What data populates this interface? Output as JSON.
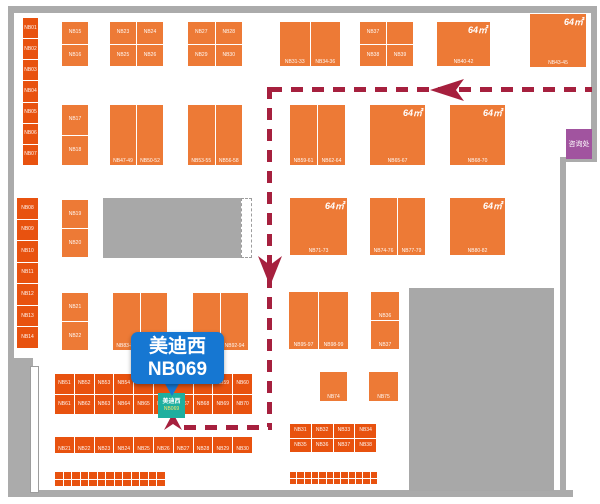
{
  "canvas": {
    "width": 600,
    "height": 504,
    "background": "#ffffff"
  },
  "colors": {
    "booth_orange": "#ED7A36",
    "booth_red": "#E8520F",
    "wall_gray": "#ABABAB",
    "block_gray": "#A8A8A8",
    "path_crimson": "#A6203E",
    "callout_blue": "#1677D2",
    "highlight_teal": "#1FAF9F",
    "info_purple": "#A1549F"
  },
  "callout": {
    "x": 131,
    "y": 332,
    "w": 93,
    "h": 52,
    "line1": "美迪西",
    "line2": "NB069",
    "tail": {
      "x": 164,
      "y": 382,
      "size": 14
    }
  },
  "highlight_booth": {
    "x": 158,
    "y": 393,
    "w": 27,
    "h": 25,
    "name": "美迪西",
    "booth_no": "NB069"
  },
  "info_box": {
    "x": 566,
    "y": 129,
    "w": 26,
    "h": 30,
    "label": "咨询处"
  },
  "structure": {
    "walls": [
      {
        "x": 8,
        "y": 6,
        "w": 589,
        "h": 7
      },
      {
        "x": 8,
        "y": 6,
        "w": 6,
        "h": 354
      },
      {
        "x": 591,
        "y": 6,
        "w": 6,
        "h": 155
      },
      {
        "x": 560,
        "y": 157,
        "w": 37,
        "h": 5
      },
      {
        "x": 560,
        "y": 157,
        "w": 6,
        "h": 340
      },
      {
        "x": 13,
        "y": 490,
        "w": 560,
        "h": 7
      },
      {
        "x": 8,
        "y": 358,
        "w": 25,
        "h": 139
      }
    ],
    "gray_blocks": [
      {
        "x": 103,
        "y": 198,
        "w": 139,
        "h": 60
      },
      {
        "x": 409,
        "y": 288,
        "w": 145,
        "h": 203
      }
    ],
    "white_slot": {
      "x": 30,
      "y": 366,
      "w": 9,
      "h": 127
    },
    "dashed_tab": {
      "x": 241,
      "y": 198,
      "w": 11,
      "h": 60
    }
  },
  "path": {
    "segments": [
      {
        "type": "h",
        "x": 270,
        "y": 87,
        "len": 322
      },
      {
        "type": "v",
        "x": 267,
        "y": 87,
        "len": 340
      },
      {
        "type": "h",
        "x": 184,
        "y": 425,
        "len": 88
      }
    ],
    "arrows": [
      {
        "dir": "left",
        "x": 430,
        "y": 79,
        "w": 34,
        "h": 22
      },
      {
        "dir": "down",
        "x": 258,
        "y": 256,
        "w": 24,
        "h": 30
      },
      {
        "dir": "up",
        "x": 164,
        "y": 413,
        "w": 18,
        "h": 17
      }
    ]
  },
  "booths": [
    {
      "id": "strip-left-1",
      "x": 23,
      "y": 18,
      "w": 15,
      "h": 147,
      "tone": "red",
      "cols": 1,
      "rows": 7,
      "labelPos": "center",
      "labels": [
        "NB01",
        "NB02",
        "NB03",
        "NB04",
        "NB05",
        "NB06",
        "NB07"
      ]
    },
    {
      "id": "strip-left-2",
      "x": 17,
      "y": 198,
      "w": 21,
      "h": 150,
      "tone": "red",
      "cols": 1,
      "rows": 7,
      "labelPos": "center",
      "labels": [
        "NB08",
        "NB09",
        "NB10",
        "NB11",
        "NB12",
        "NB13",
        "NB14"
      ]
    },
    {
      "id": "col-a",
      "x": 62,
      "y": 22,
      "w": 26,
      "h": 44,
      "tone": "orange",
      "cols": 1,
      "rows": 2,
      "labelPos": "center",
      "labels": [
        "NB15",
        "NB16"
      ]
    },
    {
      "id": "col-b",
      "x": 62,
      "y": 105,
      "w": 26,
      "h": 60,
      "tone": "orange",
      "cols": 1,
      "rows": 2,
      "labelPos": "center",
      "labels": [
        "NB17",
        "NB18"
      ]
    },
    {
      "id": "col-c",
      "x": 62,
      "y": 200,
      "w": 26,
      "h": 57,
      "tone": "orange",
      "cols": 1,
      "rows": 2,
      "labelPos": "center",
      "labels": [
        "NB19",
        "NB20"
      ]
    },
    {
      "id": "col-d",
      "x": 62,
      "y": 293,
      "w": 26,
      "h": 57,
      "tone": "orange",
      "cols": 1,
      "rows": 2,
      "labelPos": "center",
      "labels": [
        "NB21",
        "NB22"
      ]
    },
    {
      "id": "a1",
      "x": 110,
      "y": 22,
      "w": 53,
      "h": 44,
      "tone": "orange",
      "cols": 2,
      "rows": 2,
      "labelPos": "center",
      "labels": [
        "NB23",
        "NB24",
        "NB25",
        "NB26"
      ]
    },
    {
      "id": "a2",
      "x": 188,
      "y": 22,
      "w": 54,
      "h": 44,
      "tone": "orange",
      "cols": 2,
      "rows": 2,
      "labelPos": "center",
      "labels": [
        "NB27",
        "NB28",
        "NB29",
        "NB30"
      ]
    },
    {
      "id": "a3",
      "x": 280,
      "y": 22,
      "w": 60,
      "h": 44,
      "tone": "orange",
      "cols": 2,
      "rows": 1,
      "labelPos": "bottom",
      "labels": [
        "NB31-33",
        "NB34-36"
      ]
    },
    {
      "id": "a4",
      "x": 360,
      "y": 22,
      "w": 53,
      "h": 44,
      "tone": "orange",
      "cols": 2,
      "rows": 2,
      "labelPos": "center",
      "labels": [
        "NB37",
        "",
        "NB38",
        "NB39"
      ]
    },
    {
      "id": "a5",
      "x": 437,
      "y": 22,
      "w": 53,
      "h": 44,
      "tone": "orange",
      "cols": 1,
      "rows": 1,
      "labelPos": "bottom",
      "labels": [
        "NB40-42"
      ],
      "area": "64㎡"
    },
    {
      "id": "a6",
      "x": 530,
      "y": 14,
      "w": 56,
      "h": 53,
      "tone": "orange",
      "cols": 1,
      "rows": 1,
      "labelPos": "bottom",
      "labels": [
        "NB43-45"
      ],
      "area": "64㎡"
    },
    {
      "id": "b1",
      "x": 110,
      "y": 105,
      "w": 53,
      "h": 60,
      "tone": "orange",
      "cols": 2,
      "rows": 1,
      "labelPos": "bottom",
      "labels": [
        "NB47-49",
        "NB50-52"
      ]
    },
    {
      "id": "b2",
      "x": 188,
      "y": 105,
      "w": 54,
      "h": 60,
      "tone": "orange",
      "cols": 2,
      "rows": 1,
      "labelPos": "bottom",
      "labels": [
        "NB53-55",
        "NB56-58"
      ]
    },
    {
      "id": "b3",
      "x": 290,
      "y": 105,
      "w": 55,
      "h": 60,
      "tone": "orange",
      "cols": 2,
      "rows": 1,
      "labelPos": "bottom",
      "labels": [
        "NB59-61",
        "NB62-64"
      ]
    },
    {
      "id": "b4",
      "x": 370,
      "y": 105,
      "w": 55,
      "h": 60,
      "tone": "orange",
      "cols": 1,
      "rows": 1,
      "labelPos": "bottom",
      "labels": [
        "NB65-67"
      ],
      "area": "64㎡"
    },
    {
      "id": "b5",
      "x": 450,
      "y": 105,
      "w": 55,
      "h": 60,
      "tone": "orange",
      "cols": 1,
      "rows": 1,
      "labelPos": "bottom",
      "labels": [
        "NB68-70"
      ],
      "area": "64㎡"
    },
    {
      "id": "c1",
      "x": 290,
      "y": 198,
      "w": 57,
      "h": 57,
      "tone": "orange",
      "cols": 1,
      "rows": 1,
      "labelPos": "bottom",
      "labels": [
        "NB71-73"
      ],
      "area": "64㎡"
    },
    {
      "id": "c2",
      "x": 370,
      "y": 198,
      "w": 55,
      "h": 57,
      "tone": "orange",
      "cols": 2,
      "rows": 1,
      "labelPos": "bottom",
      "labels": [
        "NB74-76",
        "NB77-79"
      ]
    },
    {
      "id": "c3",
      "x": 450,
      "y": 198,
      "w": 55,
      "h": 57,
      "tone": "orange",
      "cols": 1,
      "rows": 1,
      "labelPos": "bottom",
      "labels": [
        "NB80-82"
      ],
      "area": "64㎡"
    },
    {
      "id": "d1",
      "x": 113,
      "y": 293,
      "w": 54,
      "h": 57,
      "tone": "orange",
      "cols": 2,
      "rows": 1,
      "labelPos": "bottom",
      "labels": [
        "NB83-85",
        "NB86-88"
      ]
    },
    {
      "id": "d2",
      "x": 193,
      "y": 293,
      "w": 55,
      "h": 57,
      "tone": "orange",
      "cols": 2,
      "rows": 1,
      "labelPos": "bottom",
      "labels": [
        "NB89-91",
        "NB92-94"
      ]
    },
    {
      "id": "d3",
      "x": 289,
      "y": 292,
      "w": 59,
      "h": 57,
      "tone": "orange",
      "cols": 2,
      "rows": 1,
      "labelPos": "bottom",
      "labels": [
        "NB95-97",
        "NB98-99"
      ]
    },
    {
      "id": "d4",
      "x": 371,
      "y": 292,
      "w": 28,
      "h": 57,
      "tone": "orange",
      "cols": 1,
      "rows": 2,
      "labelPos": "bottom",
      "labels": [
        "NB36",
        "NB37"
      ]
    },
    {
      "id": "sq1",
      "x": 320,
      "y": 372,
      "w": 27,
      "h": 29,
      "tone": "orange",
      "cols": 1,
      "rows": 1,
      "labelPos": "bottom",
      "labels": [
        "NB74"
      ]
    },
    {
      "id": "sq2",
      "x": 369,
      "y": 372,
      "w": 29,
      "h": 29,
      "tone": "orange",
      "cols": 1,
      "rows": 1,
      "labelPos": "bottom",
      "labels": [
        "NB75"
      ]
    },
    {
      "id": "row-e",
      "x": 55,
      "y": 374,
      "w": 197,
      "h": 40,
      "tone": "red",
      "cols": 10,
      "rows": 2,
      "labelPos": "center",
      "labels": [
        "NB51",
        "NB52",
        "NB53",
        "NB54",
        "NB55",
        "NB56",
        "NB57",
        "NB58",
        "NB59",
        "NB60",
        "NB61",
        "NB62",
        "NB63",
        "NB64",
        "NB65",
        "NB66",
        "NB67",
        "NB68",
        "NB69",
        "NB70"
      ]
    },
    {
      "id": "row-f",
      "x": 55,
      "y": 437,
      "w": 197,
      "h": 16,
      "tone": "red",
      "cols": 10,
      "rows": 1,
      "labelPos": "bottom",
      "labels": [
        "NB21",
        "NB22",
        "NB23",
        "NB24",
        "NB25",
        "NB26",
        "NB27",
        "NB28",
        "NB29",
        "NB30"
      ]
    },
    {
      "id": "f-right",
      "x": 290,
      "y": 424,
      "w": 86,
      "h": 28,
      "tone": "red",
      "cols": 4,
      "rows": 2,
      "labelPos": "center",
      "labels": [
        "NB31",
        "NB32",
        "NB33",
        "NB34",
        "NB35",
        "NB36",
        "NB37",
        "NB38"
      ]
    },
    {
      "id": "row-g",
      "x": 55,
      "y": 472,
      "w": 110,
      "h": 14,
      "tone": "red",
      "cols": 13,
      "rows": 2,
      "labelPos": "center",
      "labels": []
    },
    {
      "id": "g-right",
      "x": 290,
      "y": 472,
      "w": 87,
      "h": 12,
      "tone": "red",
      "cols": 12,
      "rows": 2,
      "labelPos": "center",
      "labels": []
    }
  ]
}
